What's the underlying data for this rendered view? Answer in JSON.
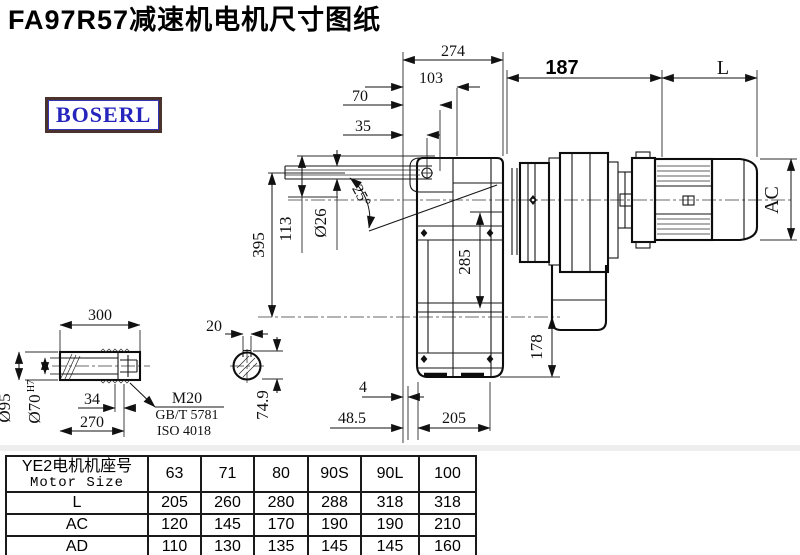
{
  "title": "FA97R57减速机电机尺寸图纸",
  "logo": {
    "text": "BOSERL",
    "text_color": "#2525bd",
    "border_color": "#4a332c"
  },
  "labels": {
    "d274": "274",
    "d103": "103",
    "d70": "70",
    "d35": "35",
    "d187": "187",
    "dL": "L",
    "d395": "395",
    "d113": "113",
    "d26": "Ø26",
    "a25": "25°",
    "d285": "285",
    "d178": "178",
    "ac": "AC",
    "d4": "4",
    "d48_5": "48.5",
    "d205": "205",
    "s300": "300",
    "s95": "Ø95",
    "s70": "Ø70",
    "s70tol": "H7",
    "s34": "34",
    "s270": "270",
    "thread": "M20",
    "std1": "GB/T 5781",
    "std2": "ISO 4018",
    "k20": "20",
    "k74_9": "74.9"
  },
  "table": {
    "header_cn": "YE2电机机座号",
    "header_en": "Motor Size",
    "columns": [
      "63",
      "71",
      "80",
      "90S",
      "90L",
      "100"
    ],
    "rows": [
      {
        "label": "L",
        "values": [
          "205",
          "260",
          "280",
          "288",
          "318",
          "318"
        ]
      },
      {
        "label": "AC",
        "values": [
          "120",
          "145",
          "170",
          "190",
          "190",
          "210"
        ]
      },
      {
        "label": "AD",
        "values": [
          "110",
          "130",
          "135",
          "145",
          "145",
          "160"
        ]
      }
    ]
  }
}
